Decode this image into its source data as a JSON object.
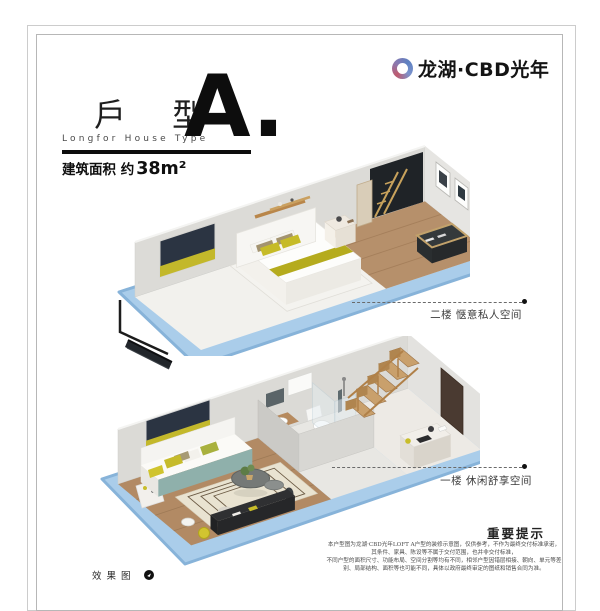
{
  "brand": {
    "name": "龙湖·CBD光年"
  },
  "title": {
    "type_cn": "戶 型",
    "type_en": "Longfor House Type",
    "type_letter": "A.",
    "area_prefix": "建筑面积 约",
    "area_value": "38m²"
  },
  "callouts": {
    "upper": "二楼 惬意私人空间",
    "lower": "一楼 休闲舒享空间"
  },
  "notice": {
    "title": "重要提示",
    "lines": [
      "本户型图为龙湖·CBD光年LOFT A户型的装修示意图，仅供参考，不作为最终交付标准承诺，",
      "其条件、家具、陈设等不属于交付范围，也并非交付标准，",
      "不同户型的面积尺寸、功能布局、空间分割等均有不同，相邻户型因错层相接、朝向、单元等差",
      "别、局部结构、面积等也可能不同，具体以政府最终审定的图纸和销售合同为准。"
    ]
  },
  "footer": {
    "render_note": "效果图"
  },
  "colors": {
    "accent_blue": "#aacdea",
    "accent_blue_dark": "#87b3d9",
    "accent_olive": "#c0b52a",
    "wood": "#b6906b",
    "art_navy": "#2b3442",
    "logo_gradient_blue": "#5d80c1",
    "logo_gradient_red": "#bf5a6e"
  }
}
